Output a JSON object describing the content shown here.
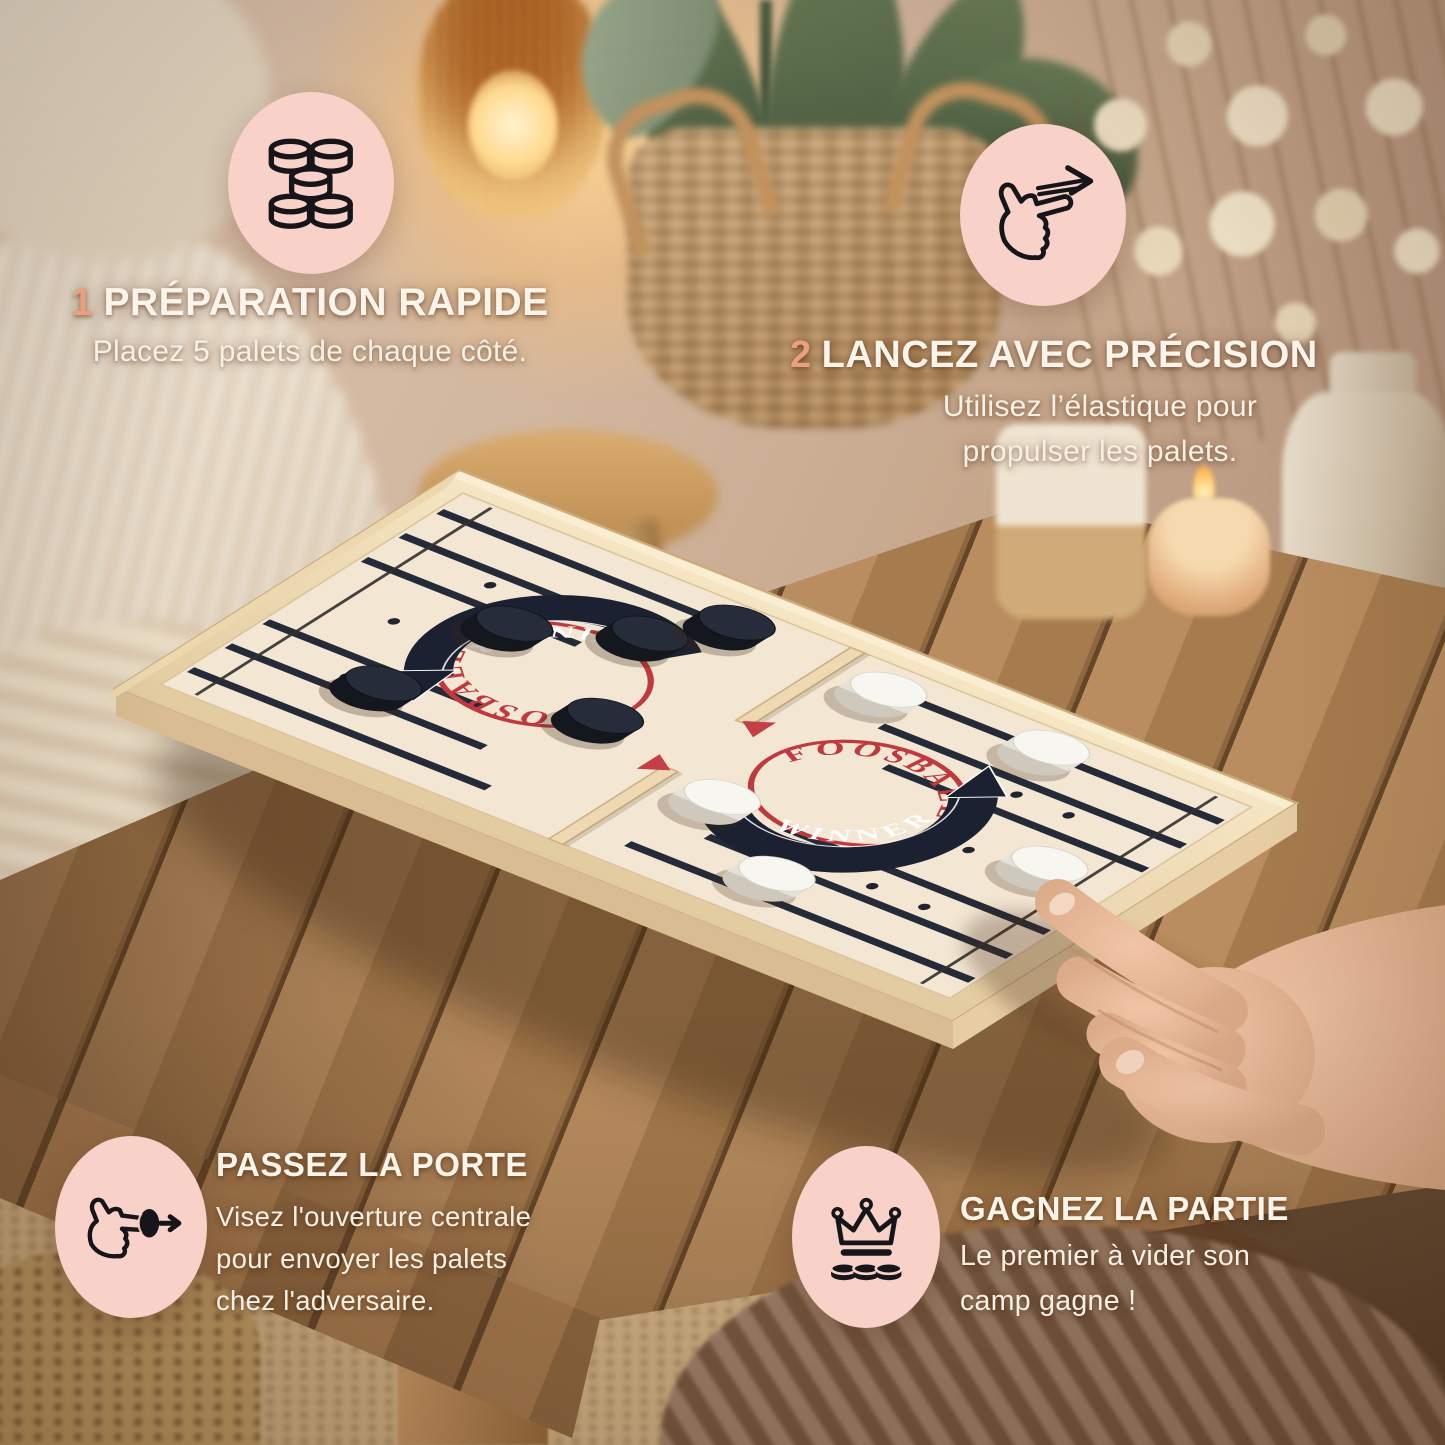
{
  "colors": {
    "circle_bg": "#f8d1c9",
    "number_accent": "#e9a081",
    "heading_text": "#faf4ea",
    "logo_red": "#bf3a3f",
    "ribbon_black": "#1b2130",
    "stripe_navy": "#242a38",
    "board_wood": "#efddb9",
    "board_field": "#f3e7d4"
  },
  "callouts": {
    "prep": {
      "number": "1",
      "title": "PRÉPARATION RAPIDE",
      "body": "Placez 5 palets de chaque côté.",
      "icon": "pucks-stack-icon"
    },
    "launch": {
      "number": "2",
      "title": "LANCEZ AVEC PRÉCISION",
      "body_lines": [
        "Utilisez l’élastique pour",
        "propulser les palets."
      ],
      "icon": "flick-hand-icon"
    },
    "gate": {
      "title": "PASSEZ LA PORTE",
      "body_lines": [
        "Visez l'ouverture centrale",
        "pour envoyer les palets",
        "chez l'adversaire."
      ],
      "icon": "flick-puck-icon"
    },
    "win": {
      "title": "GAGNEZ LA PARTIE",
      "body_lines": [
        "Le premier à vider son",
        "camp gagne !"
      ],
      "icon": "crown-pucks-icon"
    }
  },
  "board": {
    "logo_circle": "FOOSBALL",
    "logo_banner": "WINNER",
    "black_pucks": 5,
    "white_pucks": 5
  }
}
